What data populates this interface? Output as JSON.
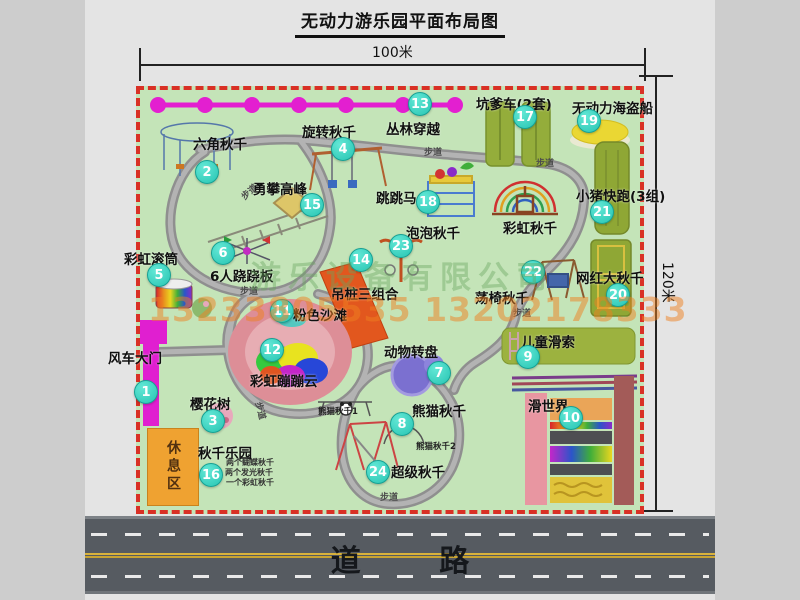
{
  "title": "无动力游乐园平面布局图",
  "dimensions": {
    "width_label": "100米",
    "height_label": "120米"
  },
  "road": {
    "label": "道 路"
  },
  "watermark": {
    "company": "游乐设备有限公司",
    "phone": "13233805535 13202178333"
  },
  "path_label": "步道",
  "attractions": [
    {
      "num": 1,
      "label": "风车大门"
    },
    {
      "num": 2,
      "label": "六角秋千"
    },
    {
      "num": 3,
      "label": "樱花树"
    },
    {
      "num": 4,
      "label": "旋转秋千"
    },
    {
      "num": 5,
      "label": "彩虹滚筒"
    },
    {
      "num": 6,
      "label": "6人跷跷板"
    },
    {
      "num": 7,
      "label": "动物转盘"
    },
    {
      "num": 8,
      "label": "熊猫秋千"
    },
    {
      "num": 9,
      "label": "儿童滑索"
    },
    {
      "num": 10,
      "label": "滑世界"
    },
    {
      "num": 11,
      "label": "粉色沙滩"
    },
    {
      "num": 12,
      "label": "彩虹蹦蹦云"
    },
    {
      "num": 13,
      "label": "丛林穿越"
    },
    {
      "num": 14,
      "label": "吊桩三组合"
    },
    {
      "num": 15,
      "label": "勇攀高峰"
    },
    {
      "num": 16,
      "label": "秋千乐园"
    },
    {
      "num": 17,
      "label": "坑爹车(2套)"
    },
    {
      "num": 18,
      "label": "跳跳马"
    },
    {
      "num": 19,
      "label": "无动力海盗船"
    },
    {
      "num": 20,
      "label": "网红大秋千"
    },
    {
      "num": 21,
      "label": "小猪快跑(3组)"
    },
    {
      "num": 22,
      "label": "荡椅秋千"
    },
    {
      "num": 23,
      "label": "泡泡秋千"
    },
    {
      "num": 24,
      "label": "超级秋千"
    }
  ],
  "unnumbered": {
    "rainbow_swing": "彩虹秋千",
    "rest_area": "休息区"
  },
  "swing_park_notes": [
    "两个蝴蝶秋千",
    "两个发光秋千",
    "一个彩虹秋千"
  ],
  "panda_sub": [
    "熊猫秋千1",
    "熊猫秋千2"
  ]
}
